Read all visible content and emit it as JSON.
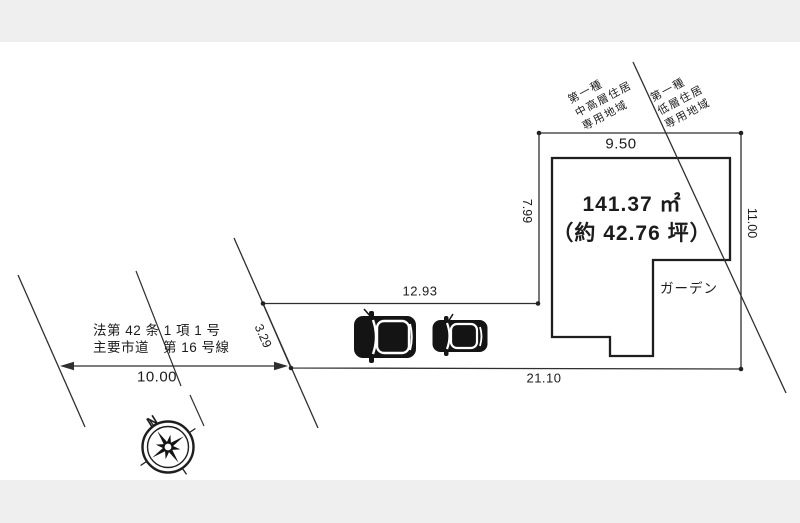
{
  "drawing": {
    "area_line1": "141.37 ㎡",
    "area_line2": "（約 42.76 坪）",
    "garden_label": "ガーデン",
    "dims": {
      "top": "9.50",
      "left": "7.99",
      "right": "11.00",
      "setback": "12.93",
      "side": "3.29",
      "bottom": "21.10",
      "road_width": "10.00"
    },
    "road": {
      "law": "法第 42 条 1 項 1 号",
      "name": "主要市道　第 16 号線"
    },
    "zoning_left": {
      "l1": "第一種",
      "l2": "中高層住居",
      "l3": "専用地域"
    },
    "zoning_right": {
      "l1": "第一種",
      "l2": "低層住居",
      "l3": "専用地域"
    },
    "compass_north": "N"
  },
  "colors": {
    "line": "#2f2f2f",
    "building_line": "#1e1e1e",
    "text": "#1c1c1c",
    "band": "#efeff0",
    "paper": "#ffffff",
    "car": "#141414"
  }
}
